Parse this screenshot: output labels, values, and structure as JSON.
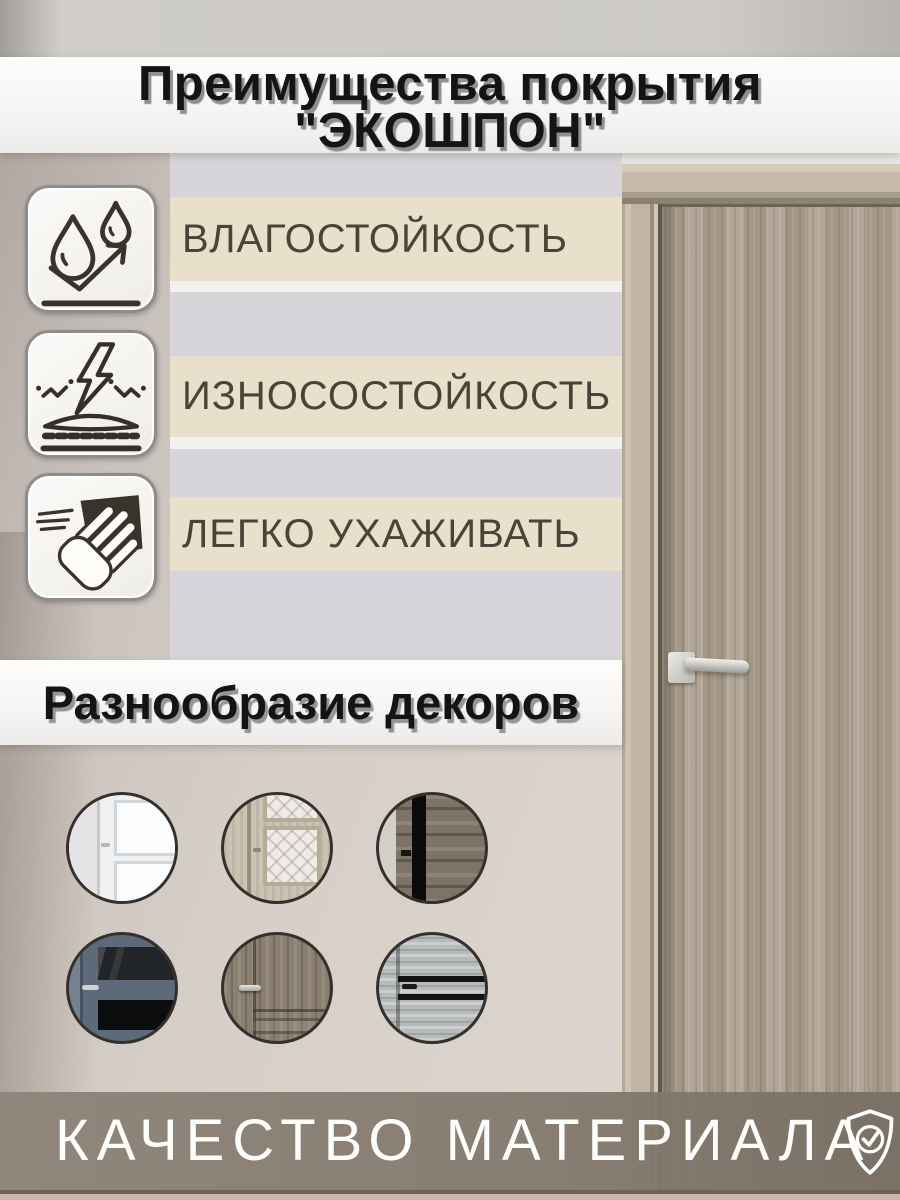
{
  "banner_top": {
    "line1": "Преимущества покрытия",
    "line2": "\"ЭКОШПОН\""
  },
  "features": [
    {
      "label": "ВЛАГОСТОЙКОСТЬ",
      "icon": "moisture-resistance-icon"
    },
    {
      "label": "ИЗНОСОСТОЙКОСТЬ",
      "icon": "wear-resistance-icon"
    },
    {
      "label": "ЛЕГКО УХАЖИВАТЬ",
      "icon": "easy-care-icon"
    }
  ],
  "decors": {
    "heading": "Разнообразие декоров",
    "swatches": [
      {
        "name": "white-classic-door-decor"
      },
      {
        "name": "beige-door-patterned-glass-decor"
      },
      {
        "name": "dark-rustic-wood-decor"
      },
      {
        "name": "blue-gray-door-dark-glass-decor"
      },
      {
        "name": "taupe-classic-wood-door-decor"
      },
      {
        "name": "gray-wood-black-molding-door-decor"
      }
    ]
  },
  "footer": {
    "label": "КАЧЕСТВО МАТЕРИАЛА",
    "icon": "shield-check-icon"
  },
  "colors": {
    "beige_strip": "#e9e0cb",
    "gray_strip": "#d8d5da",
    "footer_bar": "#8a8177",
    "feature_text": "#4b4238",
    "door_wood": "#ab9f8f"
  }
}
